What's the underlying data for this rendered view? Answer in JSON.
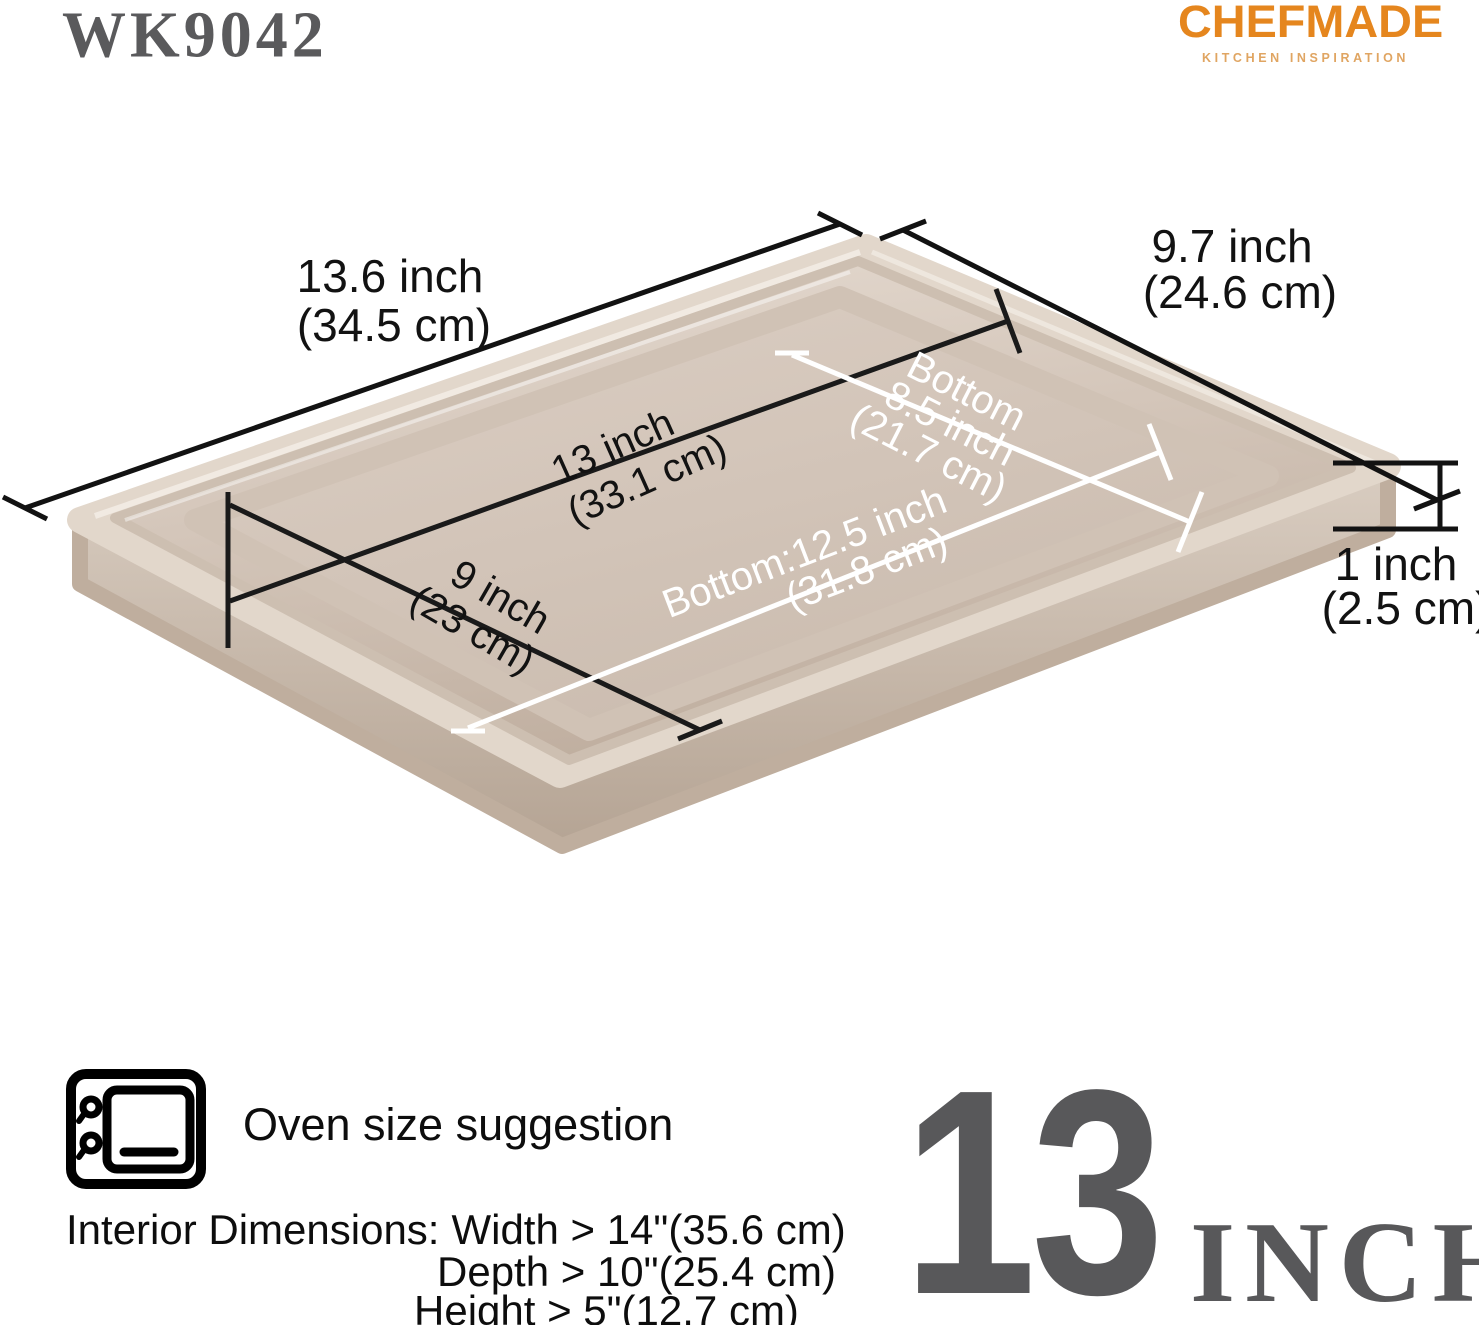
{
  "header": {
    "model": "WK9042",
    "brand": "CHEFMADE",
    "tagline": "KITCHEN INSPIRATION"
  },
  "pan_dims": {
    "top_length": {
      "line1": "13.6 inch",
      "line2": "(34.5 cm)"
    },
    "top_width": {
      "line1": "9.7 inch",
      "line2": "(24.6 cm)"
    },
    "inner_length": {
      "line1": "13 inch",
      "line2": "(33.1 cm)"
    },
    "inner_width": {
      "line1": "9 inch",
      "line2": "(23 cm)"
    },
    "bottom_width": {
      "line1": "Bottom",
      "line2": "8.5 inch",
      "line3": "(21.7 cm)"
    },
    "bottom_length": {
      "line1": "Bottom:12.5 inch",
      "line2": "(31.8 cm)"
    },
    "height": {
      "line1": "1 inch",
      "line2": "(2.5 cm)"
    }
  },
  "footer": {
    "oven_note": "Oven size suggestion",
    "interior": {
      "label": "Interior Dimensions:",
      "width": "Width > 14\"(35.6 cm)",
      "depth": "Depth > 10\"(25.4 cm)",
      "height": "Height > 5\"(12.7 cm)"
    },
    "size_badge": {
      "number": "13",
      "unit": "INCH"
    }
  },
  "colors": {
    "brand_orange": "#E5861E",
    "tagline_orange": "#E0A562",
    "stencil_gray": "#58585A",
    "pan_gold": "#D2C4B8",
    "dimension_black": "#121212",
    "dimension_white": "#FFFFFF"
  }
}
